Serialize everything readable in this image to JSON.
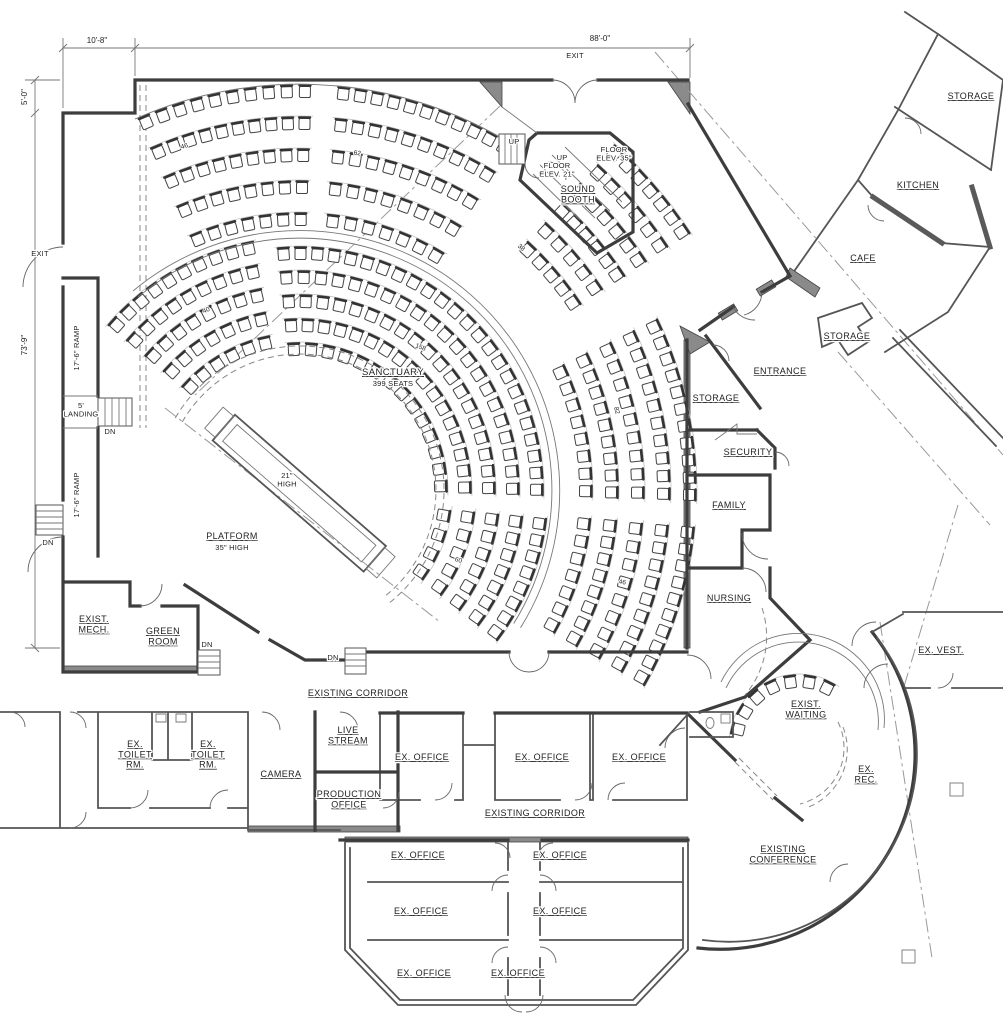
{
  "dims": {
    "top_offset": "10'-8\"",
    "top_overall": "88'-0\"",
    "left_offset": "5'-0\"",
    "left_overall": "73'-9\""
  },
  "sanctuary": {
    "name": "SANCTUARY",
    "seats": "399 SEATS",
    "platform": "PLATFORM",
    "platform_height": "35\" HIGH",
    "edge_note": "21\"\nHIGH"
  },
  "counts": {
    "upper_left": "46",
    "upper_center": "62",
    "upper_right": "38",
    "left": "40",
    "center": "158",
    "right": "82",
    "lower_center": "60",
    "lower_right": "46"
  },
  "notes": {
    "exit_top": "EXIT",
    "exit_left": "EXIT",
    "up_a": "UP",
    "up_b": "UP",
    "dn_a": "DN",
    "dn_b": "DN",
    "dn_c": "DN",
    "dn_d": "DN",
    "floor_elev_a": "FLOOR\nELEV. 21\"",
    "floor_elev_b": "FLOOR\nELEV. 35\"",
    "ramp_a": "17'-6\" RAMP",
    "ramp_b": "17'-6\" RAMP",
    "landing": "5'\nLANDING"
  },
  "rooms": {
    "sound_booth": "SOUND\nBOOTH",
    "storage_ne": "STORAGE",
    "kitchen": "KITCHEN",
    "cafe": "CAFE",
    "storage_entry": "STORAGE",
    "entrance": "ENTRANCE",
    "storage_east": "STORAGE",
    "security": "SECURITY",
    "family": "FAMILY",
    "nursing": "NURSING",
    "exist_mech": "EXIST.\nMECH.",
    "green_room": "GREEN\nROOM",
    "corridor_west": "EXISTING CORRIDOR",
    "corridor_south": "EXISTING CORRIDOR",
    "toilet_a": "EX.\nTOILET\nRM.",
    "toilet_b": "EX.\nTOILET\nRM.",
    "camera": "CAMERA",
    "live_stream": "LIVE\nSTREAM",
    "production_office": "PRODUCTION\nOFFICE",
    "office_1": "EX. OFFICE",
    "office_2": "EX. OFFICE",
    "office_3": "EX. OFFICE",
    "office_4": "EX. OFFICE",
    "office_5": "EX. OFFICE",
    "office_6": "EX. OFFICE",
    "office_7": "EX. OFFICE",
    "office_8": "EX. OFFICE",
    "office_9": "EX. OFFICE",
    "exist_waiting": "EXIST.\nWAITING",
    "ex_rec": "EX.\nREC.",
    "existing_conference": "EXISTING\nCONFERENCE",
    "ex_vest": "EX. VEST."
  }
}
